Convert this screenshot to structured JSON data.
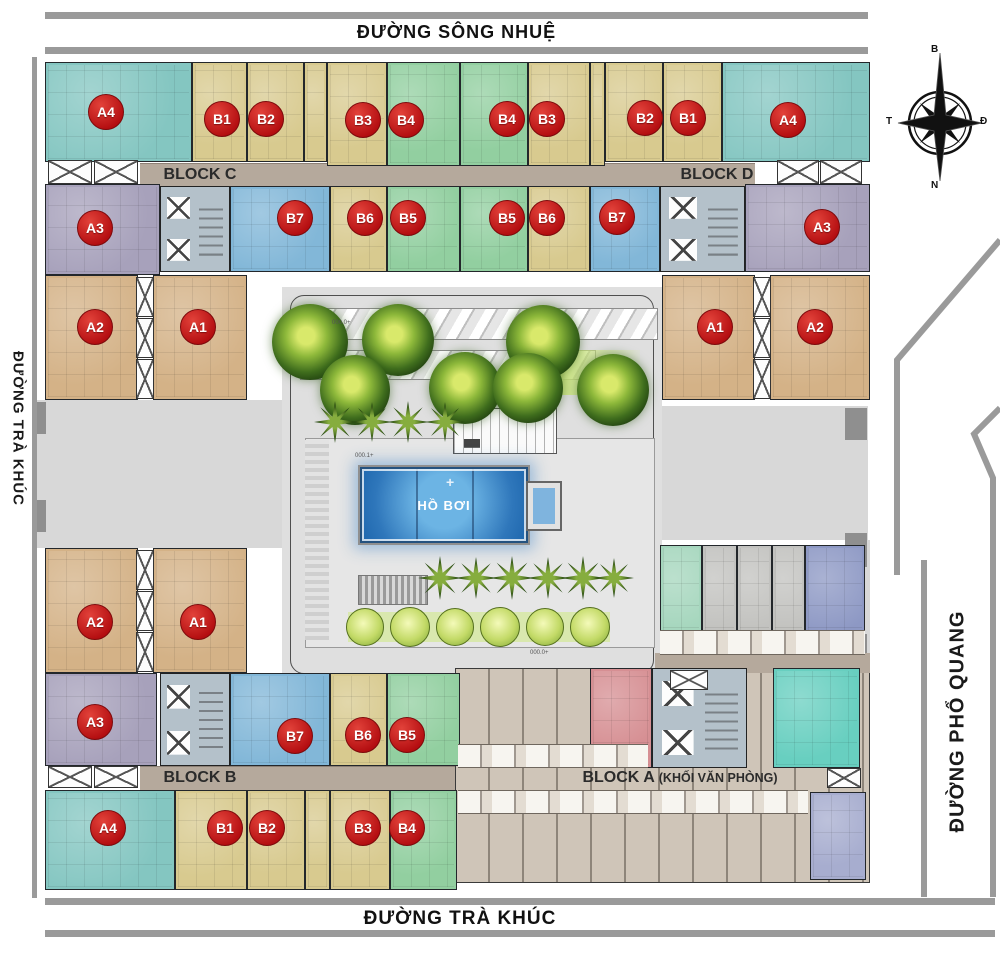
{
  "roads": {
    "top": "ĐƯỜNG SÔNG NHUỆ",
    "bottom": "ĐƯỜNG TRÀ KHÚC",
    "left": "ĐƯỜNG TRÀ KHÚC",
    "right": "ĐƯỜNG PHỔ QUANG"
  },
  "blocks": {
    "block_c": "BLOCK C",
    "block_d": "BLOCK D",
    "block_b": "BLOCK B",
    "block_a": "BLOCK A",
    "block_a_suffix": "(KHỐI VĂN PHÒNG)"
  },
  "compass": {
    "north": "B",
    "south": "N",
    "west": "T",
    "east": "Đ"
  },
  "courtyard": {
    "pool_label": "HỒ BƠI",
    "pool_cross": "+",
    "elevation_marks": [
      {
        "t": "000.0+",
        "x": 332,
        "y": 320
      },
      {
        "t": "000.1+",
        "x": 355,
        "y": 453
      },
      {
        "t": "000.0+",
        "x": 530,
        "y": 650
      }
    ]
  },
  "colors": {
    "teal": "#84c6c1",
    "tan": "#d8ca8f",
    "green": "#92cfa0",
    "blue": "#82b7d8",
    "purple": "#a7a1bb",
    "brown": "#d4b287",
    "office_pink": "#d68f93",
    "office_teal": "#68cfc0",
    "office_lav": "#a7adcf",
    "om_green": "#a5d6bd",
    "om_gray": "#c2c2bf",
    "om_blue": "#8d98c4",
    "badge_red": "#c11116",
    "corridor": "#b5a99c",
    "road_bar": "#9a9a9a",
    "pool_blue": "#1d66ad",
    "courtyard_gray": "#dfdfdf"
  },
  "units": [
    {
      "label": "A4",
      "color": "teal",
      "x": 45,
      "y": 62,
      "w": 147,
      "h": 100,
      "bx": 106,
      "by": 112
    },
    {
      "label": "B1",
      "color": "tan",
      "x": 192,
      "y": 62,
      "w": 55,
      "h": 100,
      "bx": 222,
      "by": 119
    },
    {
      "label": "B2",
      "color": "tan",
      "x": 247,
      "y": 62,
      "w": 57,
      "h": 100,
      "bx": 266,
      "by": 119
    },
    {
      "color": "tan",
      "x": 304,
      "y": 62,
      "w": 23,
      "h": 100
    },
    {
      "label": "B3",
      "color": "tan",
      "x": 327,
      "y": 62,
      "w": 60,
      "h": 104,
      "bx": 363,
      "by": 120
    },
    {
      "label": "B4",
      "color": "green",
      "x": 387,
      "y": 62,
      "w": 73,
      "h": 104,
      "bx": 406,
      "by": 120
    },
    {
      "label": "B4",
      "color": "green",
      "x": 460,
      "y": 62,
      "w": 68,
      "h": 104,
      "bx": 507,
      "by": 119
    },
    {
      "label": "B3",
      "color": "tan",
      "x": 528,
      "y": 62,
      "w": 62,
      "h": 104,
      "bx": 547,
      "by": 119
    },
    {
      "color": "tan",
      "x": 590,
      "y": 62,
      "w": 15,
      "h": 104
    },
    {
      "label": "B2",
      "color": "tan",
      "x": 605,
      "y": 62,
      "w": 58,
      "h": 100,
      "bx": 645,
      "by": 118
    },
    {
      "label": "B1",
      "color": "tan",
      "x": 663,
      "y": 62,
      "w": 59,
      "h": 100,
      "bx": 688,
      "by": 118
    },
    {
      "label": "A4",
      "color": "teal",
      "x": 722,
      "y": 62,
      "w": 148,
      "h": 100,
      "bx": 788,
      "by": 120
    },
    {
      "label": "A3",
      "color": "purple",
      "x": 45,
      "y": 184,
      "w": 115,
      "h": 91,
      "bx": 95,
      "by": 228
    },
    {
      "label": "B7",
      "color": "blue",
      "x": 230,
      "y": 186,
      "w": 100,
      "h": 86,
      "bx": 295,
      "by": 218
    },
    {
      "label": "B6",
      "color": "tan",
      "x": 330,
      "y": 186,
      "w": 57,
      "h": 86,
      "bx": 365,
      "by": 218
    },
    {
      "label": "B5",
      "color": "green",
      "x": 387,
      "y": 186,
      "w": 73,
      "h": 86,
      "bx": 408,
      "by": 218
    },
    {
      "label": "B5",
      "color": "green",
      "x": 460,
      "y": 186,
      "w": 68,
      "h": 86,
      "bx": 507,
      "by": 218
    },
    {
      "label": "B6",
      "color": "tan",
      "x": 528,
      "y": 186,
      "w": 62,
      "h": 86,
      "bx": 547,
      "by": 218
    },
    {
      "label": "B7",
      "color": "blue",
      "x": 590,
      "y": 186,
      "w": 70,
      "h": 86,
      "bx": 617,
      "by": 217
    },
    {
      "label": "A3",
      "color": "purple",
      "x": 745,
      "y": 184,
      "w": 125,
      "h": 88,
      "bx": 822,
      "by": 227
    },
    {
      "label": "A2",
      "color": "brown",
      "x": 45,
      "y": 275,
      "w": 93,
      "h": 125,
      "bx": 95,
      "by": 327
    },
    {
      "label": "A1",
      "color": "brown",
      "x": 153,
      "y": 275,
      "w": 94,
      "h": 125,
      "bx": 198,
      "by": 327
    },
    {
      "label": "A1",
      "color": "brown",
      "x": 662,
      "y": 275,
      "w": 93,
      "h": 125,
      "bx": 715,
      "by": 327
    },
    {
      "label": "A2",
      "color": "brown",
      "x": 770,
      "y": 275,
      "w": 100,
      "h": 125,
      "bx": 815,
      "by": 327
    },
    {
      "label": "A2",
      "color": "brown",
      "x": 45,
      "y": 548,
      "w": 93,
      "h": 125,
      "bx": 95,
      "by": 622
    },
    {
      "label": "A1",
      "color": "brown",
      "x": 153,
      "y": 548,
      "w": 94,
      "h": 125,
      "bx": 198,
      "by": 622
    },
    {
      "label": "A3",
      "color": "purple",
      "x": 45,
      "y": 673,
      "w": 112,
      "h": 93,
      "bx": 95,
      "by": 722
    },
    {
      "label": "B7",
      "color": "blue",
      "x": 230,
      "y": 673,
      "w": 100,
      "h": 93,
      "bx": 295,
      "by": 736
    },
    {
      "label": "B6",
      "color": "tan",
      "x": 330,
      "y": 673,
      "w": 57,
      "h": 93,
      "bx": 363,
      "by": 735
    },
    {
      "label": "B5",
      "color": "green",
      "x": 387,
      "y": 673,
      "w": 73,
      "h": 93,
      "bx": 407,
      "by": 735
    },
    {
      "label": "A4",
      "color": "teal",
      "x": 45,
      "y": 790,
      "w": 130,
      "h": 100,
      "bx": 108,
      "by": 828
    },
    {
      "label": "B1",
      "color": "tan",
      "x": 175,
      "y": 790,
      "w": 72,
      "h": 100,
      "bx": 225,
      "by": 828
    },
    {
      "label": "B2",
      "color": "tan",
      "x": 247,
      "y": 790,
      "w": 58,
      "h": 100,
      "bx": 267,
      "by": 828
    },
    {
      "color": "tan",
      "x": 305,
      "y": 790,
      "w": 25,
      "h": 100
    },
    {
      "label": "B3",
      "color": "tan",
      "x": 330,
      "y": 790,
      "w": 60,
      "h": 100,
      "bx": 363,
      "by": 828
    },
    {
      "label": "B4",
      "color": "green",
      "x": 390,
      "y": 790,
      "w": 67,
      "h": 100,
      "bx": 407,
      "by": 828
    },
    {
      "color": "om_green",
      "x": 660,
      "y": 545,
      "w": 42,
      "h": 108
    },
    {
      "color": "om_gray",
      "x": 702,
      "y": 545,
      "w": 35,
      "h": 108
    },
    {
      "color": "om_gray",
      "x": 737,
      "y": 545,
      "w": 35,
      "h": 108
    },
    {
      "color": "om_gray",
      "x": 772,
      "y": 545,
      "w": 33,
      "h": 108
    },
    {
      "color": "om_blue",
      "x": 805,
      "y": 545,
      "w": 60,
      "h": 108
    },
    {
      "color": "office_pink",
      "x": 590,
      "y": 668,
      "w": 62,
      "h": 100
    },
    {
      "color": "office_teal",
      "x": 773,
      "y": 668,
      "w": 87,
      "h": 100
    },
    {
      "color": "office_lav",
      "x": 810,
      "y": 792,
      "w": 56,
      "h": 88
    }
  ],
  "cores": [
    {
      "x": 160,
      "y": 186,
      "w": 70,
      "h": 86
    },
    {
      "x": 660,
      "y": 186,
      "w": 85,
      "h": 86
    },
    {
      "x": 160,
      "y": 673,
      "w": 70,
      "h": 93
    },
    {
      "x": 652,
      "y": 668,
      "w": 95,
      "h": 100
    }
  ],
  "shafts": [
    {
      "x": 48,
      "y": 160,
      "w": 44,
      "h": 24
    },
    {
      "x": 94,
      "y": 160,
      "w": 44,
      "h": 24
    },
    {
      "x": 777,
      "y": 160,
      "w": 42,
      "h": 24
    },
    {
      "x": 820,
      "y": 160,
      "w": 42,
      "h": 24
    },
    {
      "x": 136,
      "y": 277,
      "w": 18,
      "h": 40
    },
    {
      "x": 136,
      "y": 318,
      "w": 18,
      "h": 40
    },
    {
      "x": 136,
      "y": 359,
      "w": 18,
      "h": 40
    },
    {
      "x": 753,
      "y": 277,
      "w": 18,
      "h": 40
    },
    {
      "x": 753,
      "y": 318,
      "w": 18,
      "h": 40
    },
    {
      "x": 753,
      "y": 359,
      "w": 18,
      "h": 40
    },
    {
      "x": 136,
      "y": 550,
      "w": 18,
      "h": 40
    },
    {
      "x": 136,
      "y": 591,
      "w": 18,
      "h": 40
    },
    {
      "x": 136,
      "y": 632,
      "w": 18,
      "h": 40
    },
    {
      "x": 48,
      "y": 766,
      "w": 44,
      "h": 22
    },
    {
      "x": 94,
      "y": 766,
      "w": 44,
      "h": 22
    },
    {
      "x": 670,
      "y": 670,
      "w": 38,
      "h": 20
    },
    {
      "x": 827,
      "y": 768,
      "w": 34,
      "h": 20
    }
  ],
  "trees": [
    {
      "x": 310,
      "y": 342,
      "s": 76
    },
    {
      "x": 398,
      "y": 340,
      "s": 72
    },
    {
      "x": 543,
      "y": 342,
      "s": 74
    },
    {
      "x": 355,
      "y": 390,
      "s": 70
    },
    {
      "x": 465,
      "y": 388,
      "s": 72
    },
    {
      "x": 528,
      "y": 388,
      "s": 70
    },
    {
      "x": 613,
      "y": 390,
      "s": 72
    }
  ],
  "palms": [
    {
      "x": 335,
      "y": 422,
      "s": 42
    },
    {
      "x": 372,
      "y": 422,
      "s": 40
    },
    {
      "x": 408,
      "y": 422,
      "s": 42
    },
    {
      "x": 445,
      "y": 422,
      "s": 40
    },
    {
      "x": 440,
      "y": 578,
      "s": 44
    },
    {
      "x": 476,
      "y": 578,
      "s": 42
    },
    {
      "x": 512,
      "y": 578,
      "s": 44
    },
    {
      "x": 548,
      "y": 578,
      "s": 42
    },
    {
      "x": 583,
      "y": 578,
      "s": 44
    },
    {
      "x": 614,
      "y": 578,
      "s": 40
    }
  ],
  "shrubs": [
    {
      "x": 365,
      "y": 627,
      "s": 38
    },
    {
      "x": 410,
      "y": 627,
      "s": 40
    },
    {
      "x": 455,
      "y": 627,
      "s": 38
    },
    {
      "x": 500,
      "y": 627,
      "s": 40
    },
    {
      "x": 545,
      "y": 627,
      "s": 38
    },
    {
      "x": 590,
      "y": 627,
      "s": 40
    }
  ]
}
